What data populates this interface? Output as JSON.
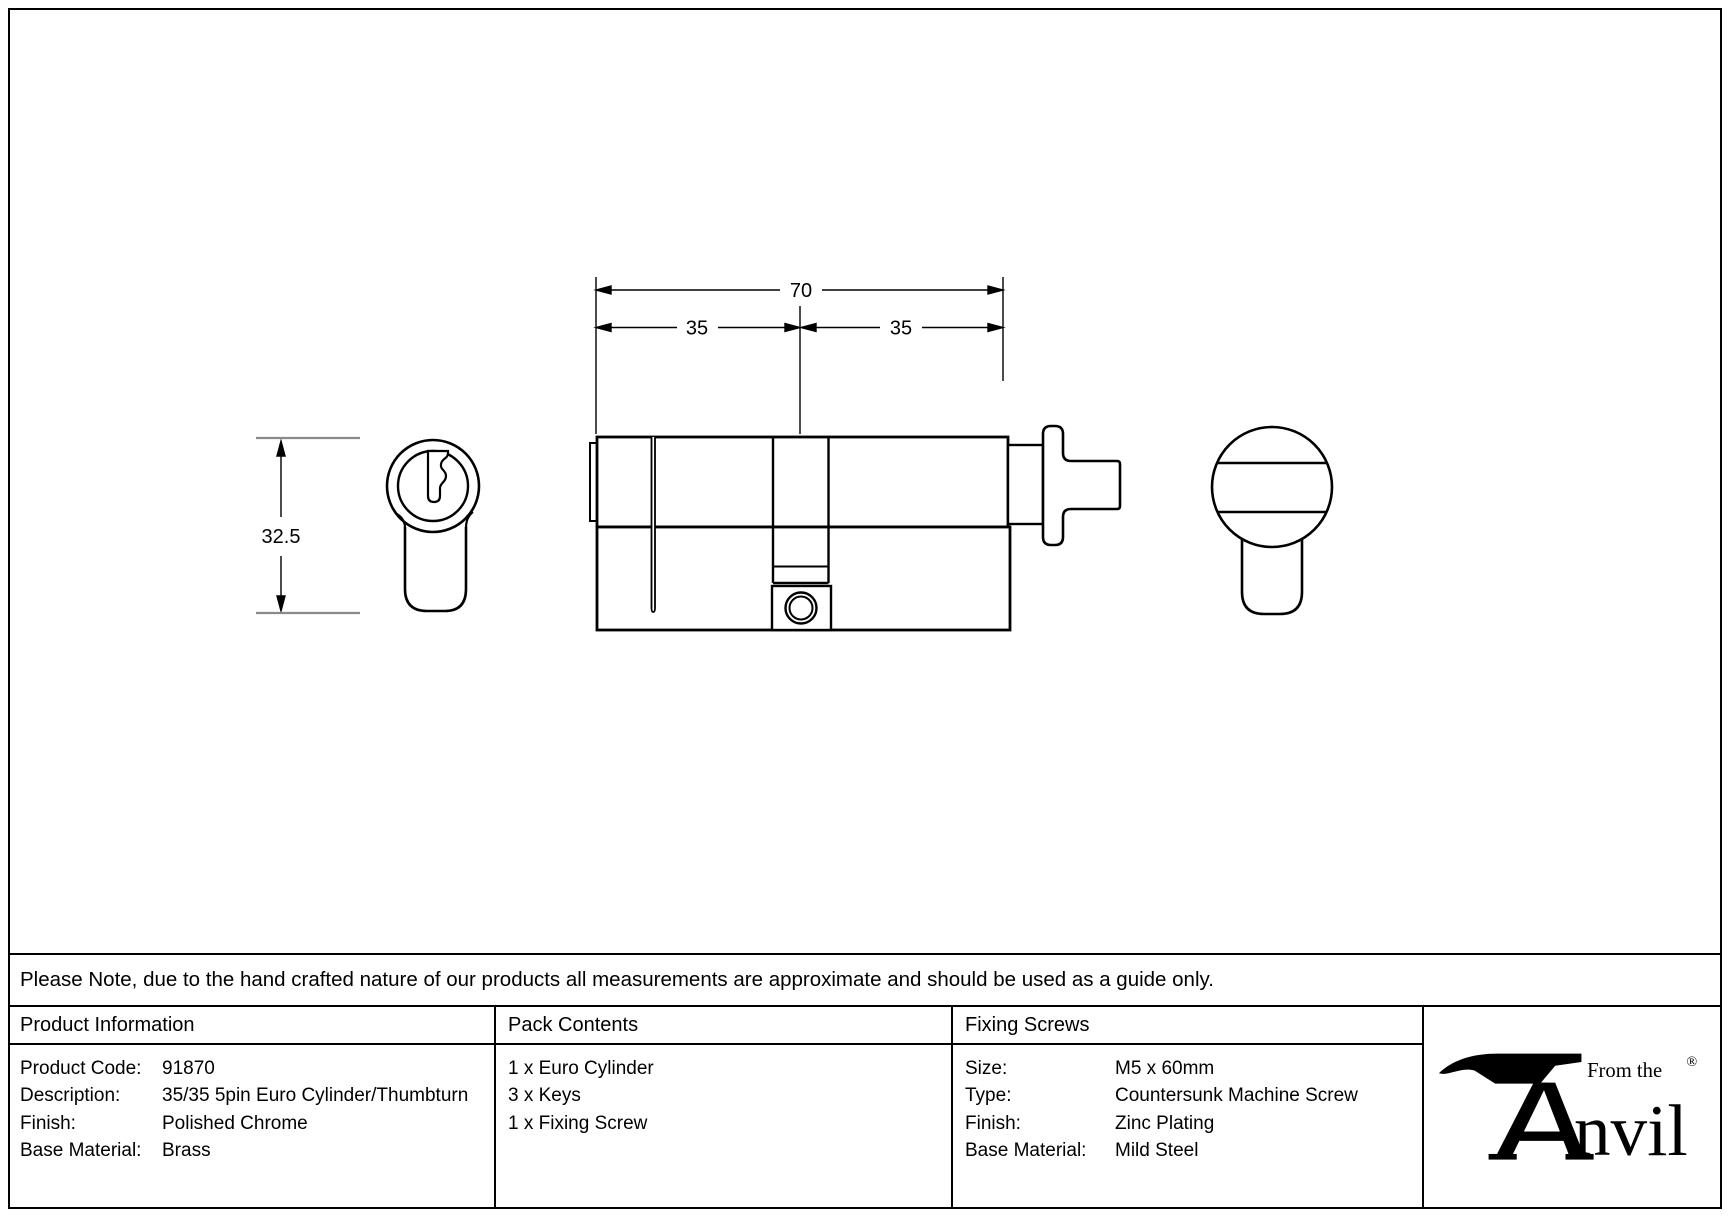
{
  "note": {
    "text": "Please Note, due to the hand crafted nature of our products all measurements are approximate and should be used as a guide only."
  },
  "diagram": {
    "dim_total_width": "70",
    "dim_left_half": "35",
    "dim_right_half": "35",
    "dim_height": "32.5"
  },
  "table": {
    "product_information": {
      "header": "Product Information",
      "rows": [
        {
          "label": "Product Code:",
          "value": "91870"
        },
        {
          "label": "Description:",
          "value": "35/35 5pin Euro Cylinder/Thumbturn"
        },
        {
          "label": "Finish:",
          "value": "Polished Chrome"
        },
        {
          "label": "Base Material:",
          "value": "Brass"
        }
      ]
    },
    "pack_contents": {
      "header": "Pack Contents",
      "items": [
        "1 x Euro Cylinder",
        "3 x Keys",
        "1 x Fixing Screw"
      ]
    },
    "fixing_screws": {
      "header": "Fixing Screws",
      "rows": [
        {
          "label": "Size:",
          "value": "M5 x 60mm"
        },
        {
          "label": "Type:",
          "value": "Countersunk Machine Screw"
        },
        {
          "label": "Finish:",
          "value": "Zinc Plating"
        },
        {
          "label": "Base Material:",
          "value": "Mild Steel"
        }
      ]
    }
  },
  "logo": {
    "tagline": "From the",
    "brand": "Anvil",
    "brand_suffix": "nvil",
    "registered": "®"
  },
  "colors": {
    "line": "#000000",
    "dim_gray": "#8a8a8a",
    "background": "#ffffff"
  }
}
